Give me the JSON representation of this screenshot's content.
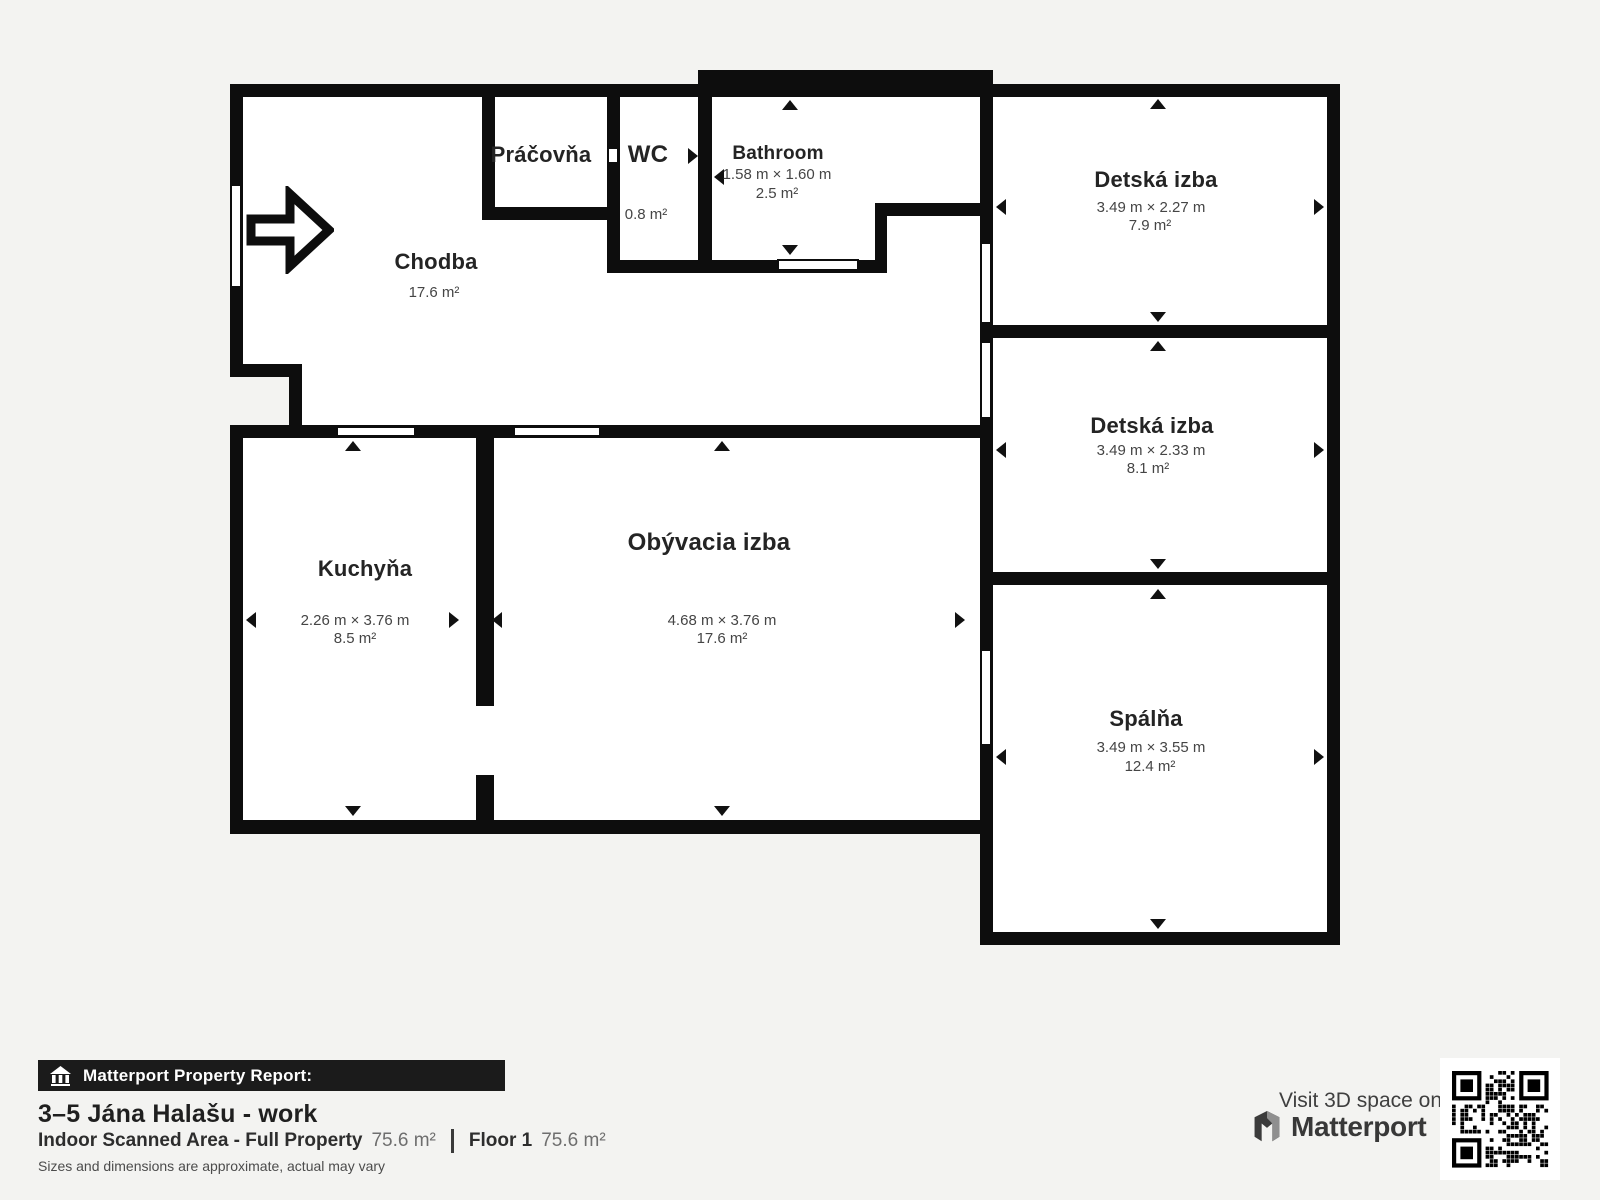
{
  "floorplan": {
    "rooms": [
      {
        "name": "Práčovňa",
        "dims": "",
        "area": ""
      },
      {
        "name": "WC",
        "dims": "",
        "area": "0.8 m²"
      },
      {
        "name": "Bathroom",
        "dims": "1.58 m × 1.60 m",
        "area": "2.5 m²"
      },
      {
        "name": "Chodba",
        "dims": "",
        "area": "17.6 m²"
      },
      {
        "name": "Detská izba",
        "dims": "3.49 m × 2.27 m",
        "area": "7.9 m²"
      },
      {
        "name": "Detská izba",
        "dims": "3.49 m × 2.33 m",
        "area": "8.1 m²"
      },
      {
        "name": "Spálňa",
        "dims": "3.49 m × 3.55 m",
        "area": "12.4 m²"
      },
      {
        "name": "Kuchyňa",
        "dims": "2.26 m × 3.76 m",
        "area": "8.5 m²"
      },
      {
        "name": "Obývacia izba",
        "dims": "4.68 m × 3.76 m",
        "area": "17.6 m²"
      }
    ],
    "colors": {
      "wall": "#0d0d0d",
      "room": "#ffffff",
      "background": "#f3f3f1"
    }
  },
  "footer": {
    "report_label": "Matterport Property Report:",
    "property_title": "3–5 Jána Halašu - work",
    "scanned_area_label": "Indoor Scanned Area - Full Property",
    "scanned_area_value": "75.6 m²",
    "floor_label": "Floor 1",
    "floor_value": "75.6 m²",
    "disclaimer": "Sizes and dimensions are approximate, actual may vary",
    "visit_label": "Visit 3D space on",
    "brand_name": "Matterport",
    "banner_color": "#1b1b1b"
  }
}
